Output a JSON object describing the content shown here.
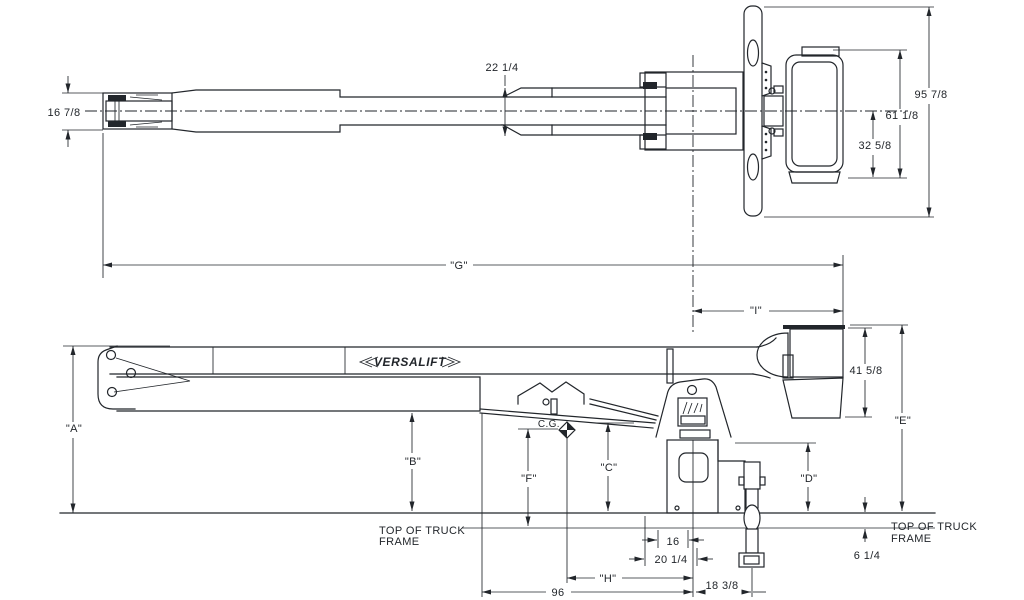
{
  "colors": {
    "line": "#22262b",
    "background": "#ffffff"
  },
  "brand": "VERSALIFT",
  "top_view": {
    "tip_width": "16 7/8",
    "boom_width": "22 1/4",
    "overall_width": "95 7/8",
    "platform_span": "61 1/8",
    "platform_lower": "32 5/8",
    "overall_length": "\"G\"",
    "center_to_platform": "\"I\""
  },
  "side_view": {
    "height_a": "\"A\"",
    "height_b": "\"B\"",
    "height_c": "\"C\"",
    "height_d": "\"D\"",
    "height_e": "\"E\"",
    "height_f": "\"F\"",
    "span_h": "\"H\"",
    "platform_height": "41 5/8",
    "frame_height": "6 1/4",
    "base_width": "16",
    "base_plate_width": "20 1/4",
    "center_to_jack": "18 3/8",
    "cg_to_tip": "96",
    "cg": "C.G.",
    "frame_left": [
      "TOP OF TRUCK",
      "FRAME"
    ],
    "frame_right": [
      "TOP OF TRUCK",
      "FRAME"
    ]
  }
}
